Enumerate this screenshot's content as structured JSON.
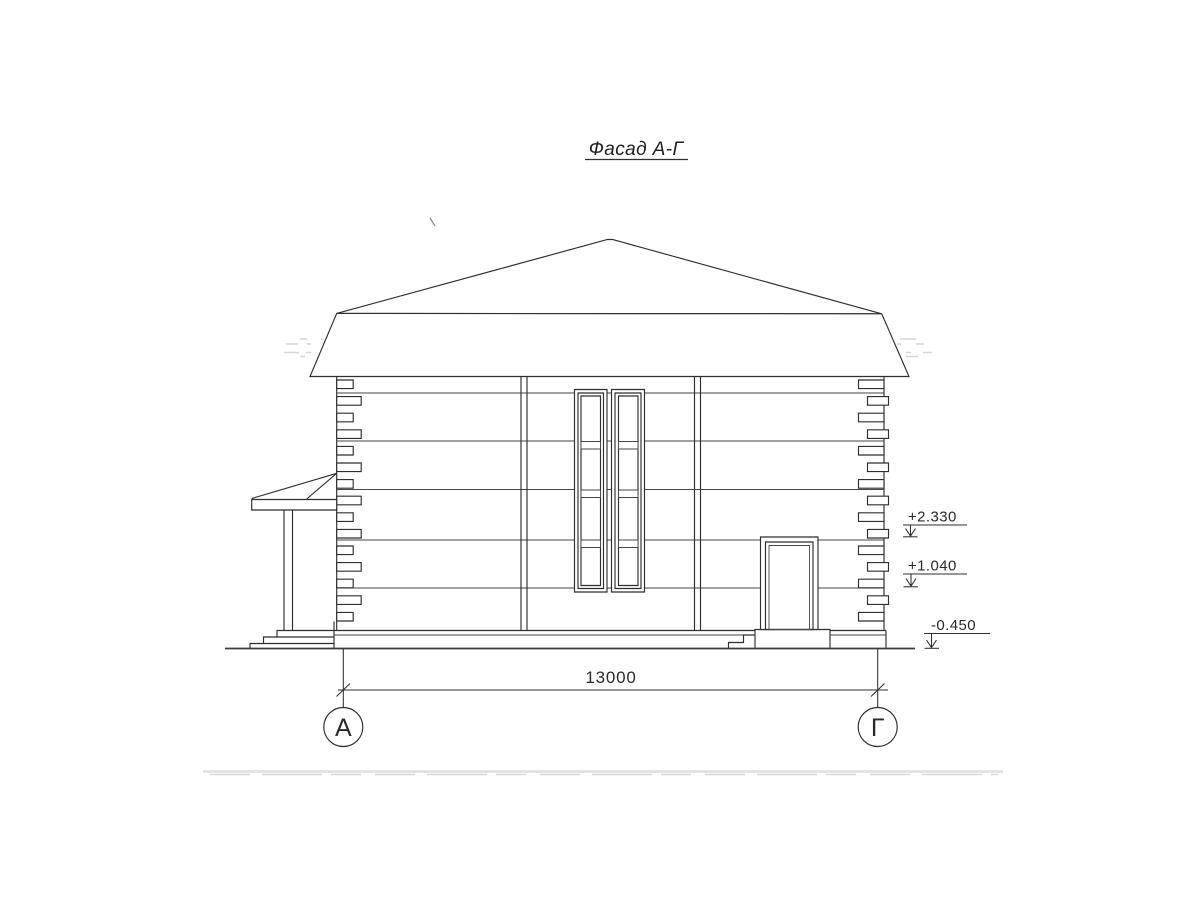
{
  "drawing": {
    "title": "Фасад А-Г",
    "dimension_label": "13000",
    "elevation_marks": [
      {
        "label": "+2.330"
      },
      {
        "label": "+1.040"
      },
      {
        "label": "-0.450"
      }
    ],
    "axis_markers": [
      {
        "label": "А"
      },
      {
        "label": "Г"
      }
    ]
  }
}
